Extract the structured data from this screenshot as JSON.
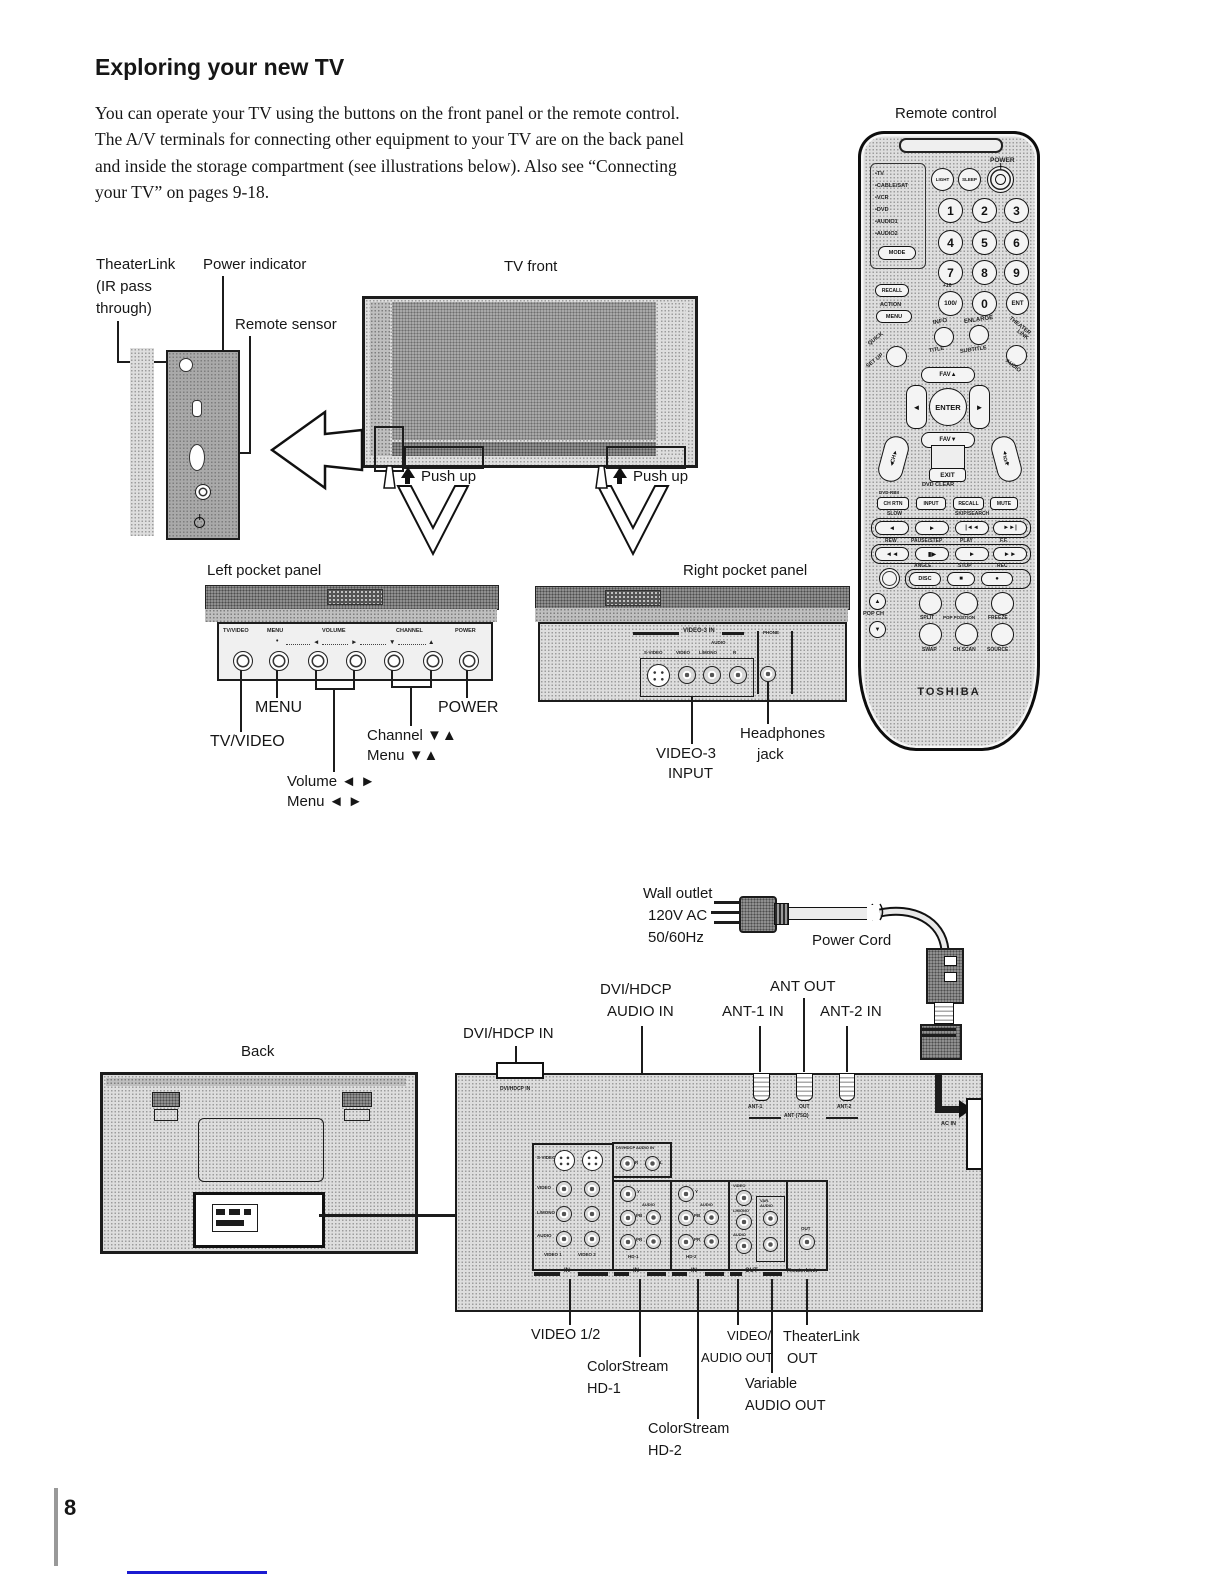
{
  "page": {
    "title": "Exploring your new TV",
    "intro": "You can operate your TV using the buttons on the front panel or the remote control. The A/V terminals for connecting other equipment to your TV are on the back panel and inside the storage compartment (see illustrations below). Also see “Connecting your TV” on pages 9-18.",
    "page_number": "8"
  },
  "tv_front": {
    "section_label": "TV front",
    "theaterlink_lines": [
      "TheaterLink",
      "(IR pass",
      "through)"
    ],
    "power_indicator": "Power indicator",
    "remote_sensor": "Remote sensor",
    "push_up": "Push up"
  },
  "left_pocket": {
    "section_label": "Left pocket panel",
    "panel": {
      "tv_video": "TV/VIDEO",
      "menu": "MENU",
      "volume": "VOLUME",
      "channel": "CHANNEL",
      "power": "POWER",
      "dot": "•",
      "left": "◄",
      "right": "►",
      "down": "▼",
      "up": "▲"
    },
    "callouts": {
      "menu": "MENU",
      "power": "POWER",
      "tv_video": "TV/VIDEO",
      "channel": "Channel ▼▲",
      "channel_menu": "Menu ▼▲",
      "volume": "Volume ◄ ►",
      "volume_menu": "Menu ◄ ►"
    }
  },
  "right_pocket": {
    "section_label": "Right pocket panel",
    "group_label": "VIDEO-3 IN",
    "audio_label": "AUDIO",
    "s_video": "S-VIDEO",
    "video": "VIDEO",
    "l_mono": "L/MONO",
    "r": "R",
    "phone_label": "PHONE",
    "callouts": {
      "video3_line1": "VIDEO-3",
      "video3_line2": "INPUT",
      "headphones_line1": "Headphones",
      "headphones_line2": "jack"
    }
  },
  "remote": {
    "section_label": "Remote control",
    "brand": "TOSHIBA",
    "modes": [
      "•TV",
      "•CABLE/SAT",
      "•VCR",
      "•DVD",
      "•AUDIO1",
      "•AUDIO2"
    ],
    "mode_btn": "MODE",
    "light_btn": "LIGHT",
    "sleep_btn": "SLEEP",
    "power_label": "POWER",
    "digits": [
      "1",
      "2",
      "3",
      "4",
      "5",
      "6",
      "7",
      "8",
      "9"
    ],
    "plus10_label": "+10",
    "hundred_btn": "100/",
    "zero_btn": "0",
    "ent_btn": "ENT",
    "recall_btn": "RECALL",
    "action_label": "ACTION",
    "menu_btn": "MENU",
    "quick_label": "QUICK",
    "setup_label": "SET UP",
    "info_label": "INFO",
    "title_label": "TITLE",
    "enlarge_label": "ENLARGE",
    "subtitle_label": "SUBTITLE",
    "theater_label": "THEATER",
    "link_label": "LINK",
    "audio_label": "AUDIO",
    "fav_up": "FAV▲",
    "fav_down": "FAV▼",
    "enter_btn": "ENTER",
    "left_glyph": "◄",
    "right_glyph": "►",
    "up_glyph": "▲",
    "down_glyph": "▼",
    "ch_label": "CH",
    "vol_label": "VOL",
    "exit_btn": "EXIT",
    "dvd_clear": "DVD CLEAR",
    "dvd_rbii": "DVD-RBII",
    "ch_rtn_btn": "CH RTN",
    "input_btn": "INPUT",
    "recall2_btn": "RECALL",
    "mute_btn": "MUTE",
    "slow_label": "SLOW",
    "skip_search_label": "SKIP/SEARCH",
    "t1": [
      "◄",
      "►",
      "|◄◄",
      "►►|"
    ],
    "rew_label": "REW",
    "pause_label": "PAUSE/STEP",
    "play_label": "PLAY",
    "ff_label": "F.F.",
    "t2": [
      "◄◄",
      "▮▶",
      "►",
      "►►"
    ],
    "angle_label": "ANGLE",
    "stop_label": "STOP",
    "rec_label": "REC",
    "disc_btn": "DISC",
    "stop_glyph": "■",
    "rec_glyph": "●",
    "pop_ch_label": "POP CH",
    "split_btn": "SPLIT",
    "pop_position_btn": "POP POSITION",
    "freeze_btn": "FREEZE",
    "swap_btn": "SWAP",
    "ch_scan_btn": "CH SCAN",
    "source_btn": "SOURCE"
  },
  "back_section": {
    "back_label": "Back",
    "wall_outlet_lines": [
      "Wall outlet",
      "120V AC",
      "50/60Hz"
    ],
    "power_cord": "Power Cord",
    "dvi_audio_lines": [
      "DVI/HDCP",
      "AUDIO IN"
    ],
    "ant_out": "ANT OUT",
    "ant1_in": "ANT-1 IN",
    "ant2_in": "ANT-2 IN",
    "dvi_in": "DVI/HDCP IN",
    "compartment": {
      "dvi_port": "DVI/HDCP IN",
      "audio_in_box": "DVI/HDCP AUDIO IN",
      "r": "R",
      "l": "L",
      "rows_g1": [
        "S-VIDEO",
        "VIDEO",
        "L/MONO",
        "AUDIO"
      ],
      "cols_g1": [
        "VIDEO 1",
        "VIDEO 2"
      ],
      "y": "Y",
      "pb": "PB",
      "pr": "PR",
      "audio": "AUDIO",
      "video": "VIDEO",
      "l_mono": "L/MONO",
      "var_line1": "VAR.",
      "var_line2": "AUDIO",
      "hd1_tag": "HD-1",
      "hd2_tag": "HD-2",
      "out_small": "OUT",
      "brackets": [
        "IN",
        "IN",
        "IN",
        "OUT",
        "TheaterLink"
      ],
      "ant_labels": [
        "ANT-1",
        "OUT",
        "ANT-2"
      ],
      "ant_bracket": "ANT (75Ω)",
      "ac_in": "AC IN"
    },
    "callouts": {
      "video12": "VIDEO 1/2",
      "cs1_lines": [
        "ColorStream",
        "HD-1"
      ],
      "cs2_lines": [
        "ColorStream",
        "HD-2"
      ],
      "vao_lines": [
        "VIDEO/",
        "AUDIO OUT"
      ],
      "var_lines": [
        "Variable",
        "AUDIO OUT"
      ],
      "tl_lines": [
        "TheaterLink",
        "OUT"
      ]
    }
  }
}
